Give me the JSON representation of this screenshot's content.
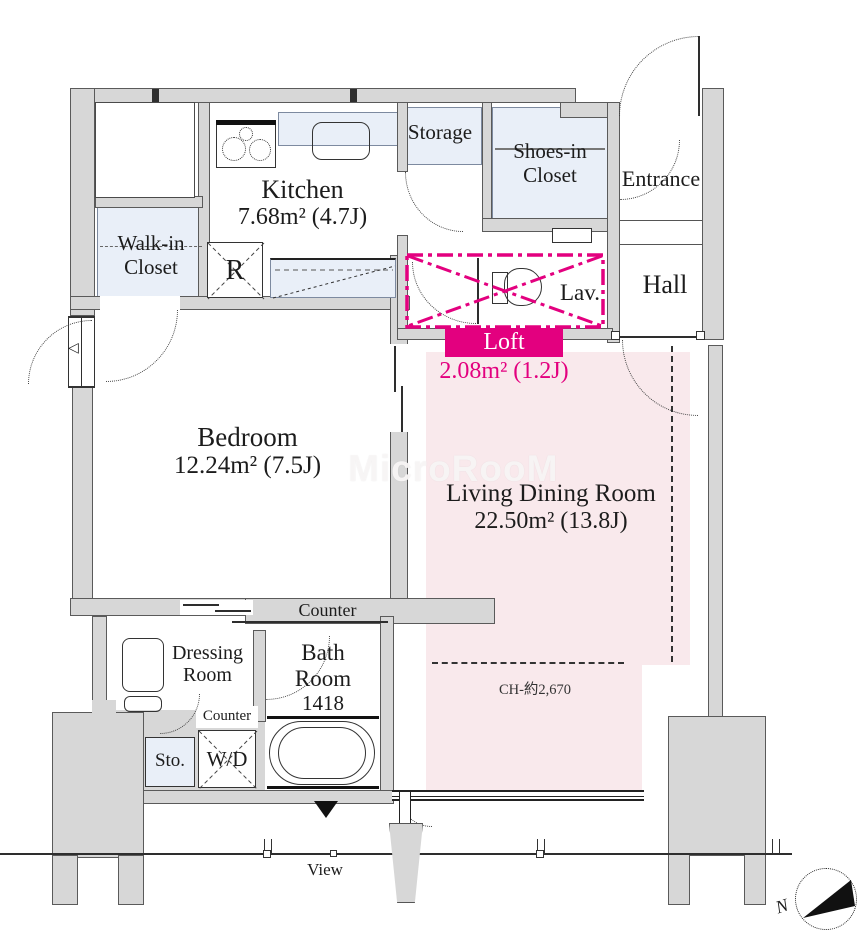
{
  "palette": {
    "wall_gray": "#d7d7d7",
    "closet_blue": "#e9eff8",
    "living_pink": "#f9e9ec",
    "accent_magenta": "#e3007f",
    "line_color": "#2e2e2e"
  },
  "watermark": "MicroRooM",
  "rooms": {
    "kitchen": {
      "name": "Kitchen",
      "area": "7.68m² (4.7J)"
    },
    "walk_in_closet": {
      "line1": "Walk-in",
      "line2": "Closet"
    },
    "refrigerator": {
      "label": "R"
    },
    "storage": {
      "name": "Storage"
    },
    "shoes_in_closet": {
      "line1": "Shoes-in",
      "line2": "Closet"
    },
    "entrance": {
      "name": "Entrance"
    },
    "hall": {
      "name": "Hall"
    },
    "lavatory": {
      "name": "Lav."
    },
    "loft": {
      "name": "Loft",
      "area": "2.08m² (1.2J)"
    },
    "bedroom": {
      "name": "Bedroom",
      "area": "12.24m² (7.5J)"
    },
    "living_dining": {
      "name": "Living Dining Room",
      "area": "22.50m² (13.8J)",
      "ceiling_height": "CH-約2,670"
    },
    "counter": {
      "label": "Counter"
    },
    "dressing_room": {
      "line1": "Dressing",
      "line2": "Room"
    },
    "bath_room": {
      "line1": "Bath",
      "line2": "Room",
      "size": "1418"
    },
    "counter_small": {
      "label": "Counter"
    },
    "storage_small": {
      "label": "Sto."
    },
    "washer_dryer": {
      "label": "W/D"
    },
    "balcony": {
      "view_label": "View"
    },
    "compass": {
      "north_label": "N"
    }
  },
  "icons": {
    "stove": "stove-icon",
    "sink": "sink-icon",
    "toilet": "toilet-icon",
    "bathtub": "bathtub-icon",
    "washbasin": "washbasin-icon",
    "compass": "compass-icon",
    "view_direction": "view-direction-triangle",
    "window_marker": "window-triangle-marker"
  }
}
